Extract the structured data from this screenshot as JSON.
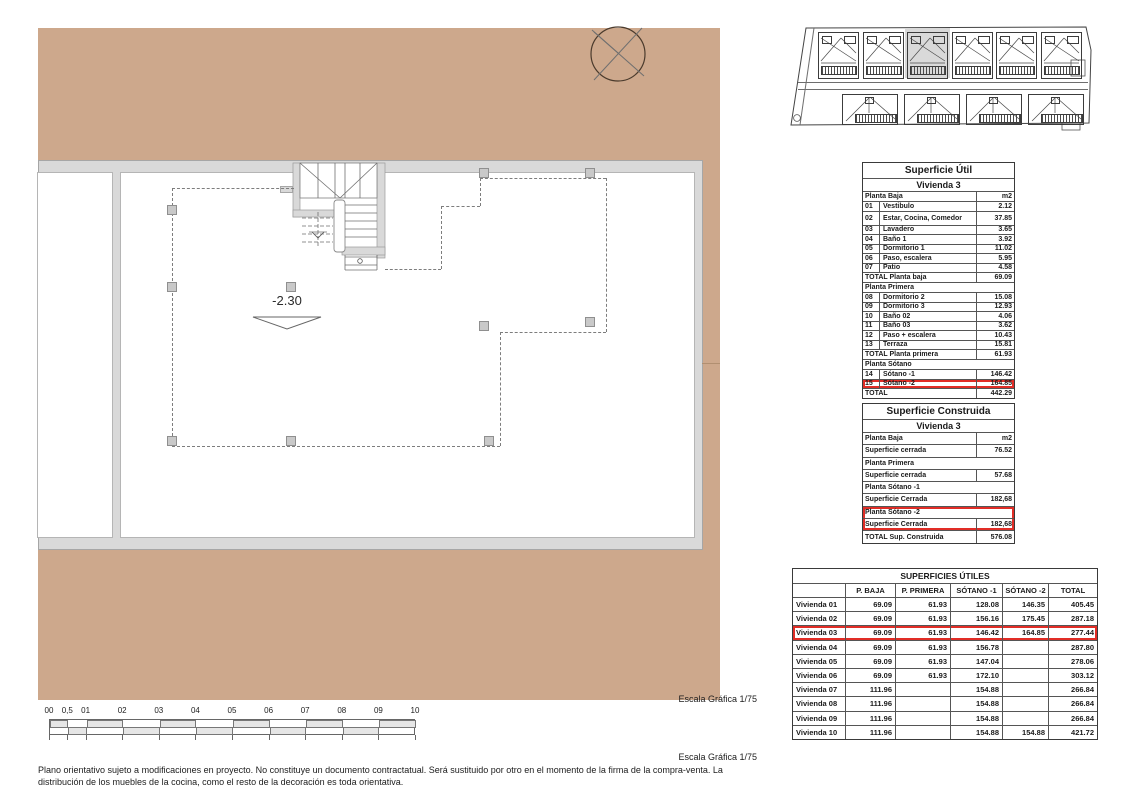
{
  "plan": {
    "level_label": "-2.30",
    "scale_label": "Escala Gráfica 1/75"
  },
  "site_plan": {
    "top_unit_count": 6,
    "bottom_unit_count": 4,
    "highlighted_top_unit_index": 2
  },
  "superficie_util": {
    "title": "Superficie Útil",
    "subtitle": "Vivienda 3",
    "rows": [
      {
        "kind": "section",
        "label": "Planta Baja",
        "value": "m2"
      },
      {
        "kind": "item",
        "num": "01",
        "label": "Vestibulo",
        "value": "2.12"
      },
      {
        "kind": "item",
        "num": "02",
        "label": "Estar, Cocina, Comedor",
        "value": "37.85",
        "tall": true
      },
      {
        "kind": "item",
        "num": "03",
        "label": "Lavadero",
        "value": "3.65"
      },
      {
        "kind": "item",
        "num": "04",
        "label": "Baño 1",
        "value": "3.92"
      },
      {
        "kind": "item",
        "num": "05",
        "label": "Dormitorio 1",
        "value": "11.02"
      },
      {
        "kind": "item",
        "num": "06",
        "label": "Paso, escalera",
        "value": "5.95"
      },
      {
        "kind": "item",
        "num": "07",
        "label": "Patio",
        "value": "4.58"
      },
      {
        "kind": "total",
        "label": "TOTAL Planta baja",
        "value": "69.09"
      },
      {
        "kind": "section",
        "label": "Planta Primera",
        "value": ""
      },
      {
        "kind": "item",
        "num": "08",
        "label": "Dormitorio 2",
        "value": "15.08"
      },
      {
        "kind": "item",
        "num": "09",
        "label": "Dormitorio 3",
        "value": "12.93"
      },
      {
        "kind": "item",
        "num": "10",
        "label": "Baño 02",
        "value": "4.06"
      },
      {
        "kind": "item",
        "num": "11",
        "label": "Baño 03",
        "value": "3.62"
      },
      {
        "kind": "item",
        "num": "12",
        "label": "Paso + escalera",
        "value": "10.43"
      },
      {
        "kind": "item",
        "num": "13",
        "label": "Terraza",
        "value": "15.81"
      },
      {
        "kind": "total",
        "label": "TOTAL Planta primera",
        "value": "61.93"
      },
      {
        "kind": "section",
        "label": "Planta Sótano",
        "value": ""
      },
      {
        "kind": "item",
        "num": "14",
        "label": "Sótano -1",
        "value": "146.42"
      },
      {
        "kind": "item",
        "num": "15",
        "label": "Sótano -2",
        "value": "164.85",
        "highlight": true
      },
      {
        "kind": "total",
        "label": "TOTAL",
        "value": "442.29"
      }
    ]
  },
  "superficie_construida": {
    "title": "Superficie Construida",
    "subtitle": "Vivienda 3",
    "rows": [
      {
        "kind": "section",
        "label": "Planta Baja",
        "value": "m2"
      },
      {
        "kind": "row",
        "label": "Superficie cerrada",
        "value": "76.52"
      },
      {
        "kind": "section",
        "label": "Planta Primera",
        "value": ""
      },
      {
        "kind": "row",
        "label": "Superficie cerrada",
        "value": "57.68"
      },
      {
        "kind": "section",
        "label": "Planta Sótano -1",
        "value": ""
      },
      {
        "kind": "row",
        "label": "Superficie Cerrada",
        "value": "182,68"
      },
      {
        "kind": "section",
        "label": "Planta Sótano -2",
        "value": "",
        "highlight": true
      },
      {
        "kind": "row",
        "label": "Superficie Cerrada",
        "value": "182,68",
        "highlight": true
      },
      {
        "kind": "total",
        "label": "TOTAL Sup. Construida",
        "value": "576.08"
      }
    ]
  },
  "superficies_utiles": {
    "title": "SUPERFICIES ÚTILES",
    "columns": [
      "",
      "P. BAJA",
      "P. PRIMERA",
      "SÓTANO -1",
      "SÓTANO -2",
      "TOTAL"
    ],
    "rows": [
      {
        "label": "Vivienda 01",
        "values": [
          "69.09",
          "61.93",
          "128.08",
          "146.35",
          "405.45"
        ]
      },
      {
        "label": "Vivienda 02",
        "values": [
          "69.09",
          "61.93",
          "156.16",
          "175.45",
          "287.18"
        ]
      },
      {
        "label": "Vivienda 03",
        "values": [
          "69.09",
          "61.93",
          "146.42",
          "164.85",
          "277.44"
        ],
        "highlight": true
      },
      {
        "label": "Vivienda 04",
        "values": [
          "69.09",
          "61.93",
          "156.78",
          "",
          "287.80"
        ]
      },
      {
        "label": "Vivienda 05",
        "values": [
          "69.09",
          "61.93",
          "147.04",
          "",
          "278.06"
        ]
      },
      {
        "label": "Vivienda 06",
        "values": [
          "69.09",
          "61.93",
          "172.10",
          "",
          "303.12"
        ]
      },
      {
        "label": "Vivienda 07",
        "values": [
          "111.96",
          "",
          "154.88",
          "",
          "266.84"
        ]
      },
      {
        "label": "Vivienda 08",
        "values": [
          "111.96",
          "",
          "154.88",
          "",
          "266.84"
        ]
      },
      {
        "label": "Vivienda 09",
        "values": [
          "111.96",
          "",
          "154.88",
          "",
          "266.84"
        ]
      },
      {
        "label": "Vivienda 10",
        "values": [
          "111.96",
          "",
          "154.88",
          "154.88",
          "421.72"
        ]
      }
    ]
  },
  "scale_bar": {
    "labels": [
      "00",
      "0,5",
      "01",
      "02",
      "03",
      "04",
      "05",
      "06",
      "07",
      "08",
      "09",
      "10"
    ]
  },
  "footer": {
    "scale_label": "Escala Gráfica 1/75",
    "disclaimer": "Plano orientativo sujeto a modificaciones en proyecto. No constituye un documento contractatual. Será sustituido por otro en el momento de la firma de la compra-venta. La distribución de los muebles de la cocina, como el resto de la decoración es toda orientativa."
  },
  "colors": {
    "terrain": "#cda88c",
    "wall_grey": "#d9d9d9",
    "highlight_red": "#e12d26",
    "site_highlight": "#d9d9d9"
  }
}
